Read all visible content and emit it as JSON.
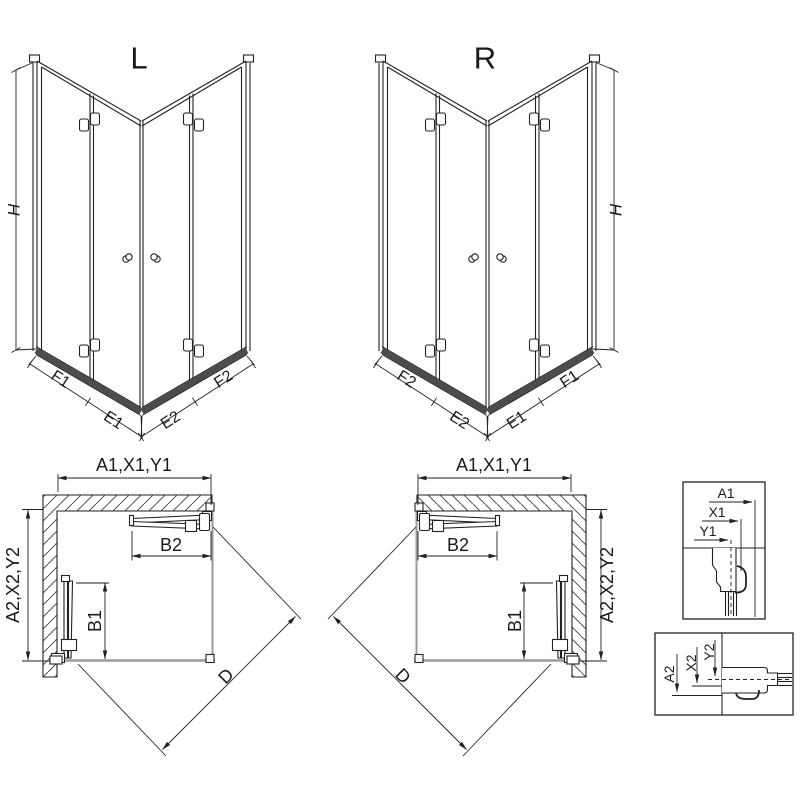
{
  "drawing": {
    "type": "shower-enclosure-technical-drawing",
    "colors": {
      "line": "#222222",
      "sill": "#4c4c4c",
      "floor": "#9a9a9a",
      "background": "#ffffff"
    },
    "iso": [
      {
        "title": "L",
        "h": "H",
        "base": [
          "F1",
          "E1",
          "E2",
          "F2"
        ]
      },
      {
        "title": "R",
        "h": "H",
        "base": [
          "F2",
          "E2",
          "E1",
          "F1"
        ]
      }
    ],
    "plans": [
      {
        "width": "A1,X1,Y1",
        "depth": "A2,X2,Y2",
        "top_door": "B2",
        "side_door": "B1",
        "diagonal": "D"
      },
      {
        "width": "A1,X1,Y1",
        "depth": "A2,X2,Y2",
        "top_door": "B2",
        "side_door": "B1",
        "diagonal": "D"
      }
    ],
    "details": [
      {
        "labels": [
          "A1",
          "X1",
          "Y1"
        ]
      },
      {
        "labels": [
          "A2",
          "X2",
          "Y2"
        ]
      }
    ]
  }
}
